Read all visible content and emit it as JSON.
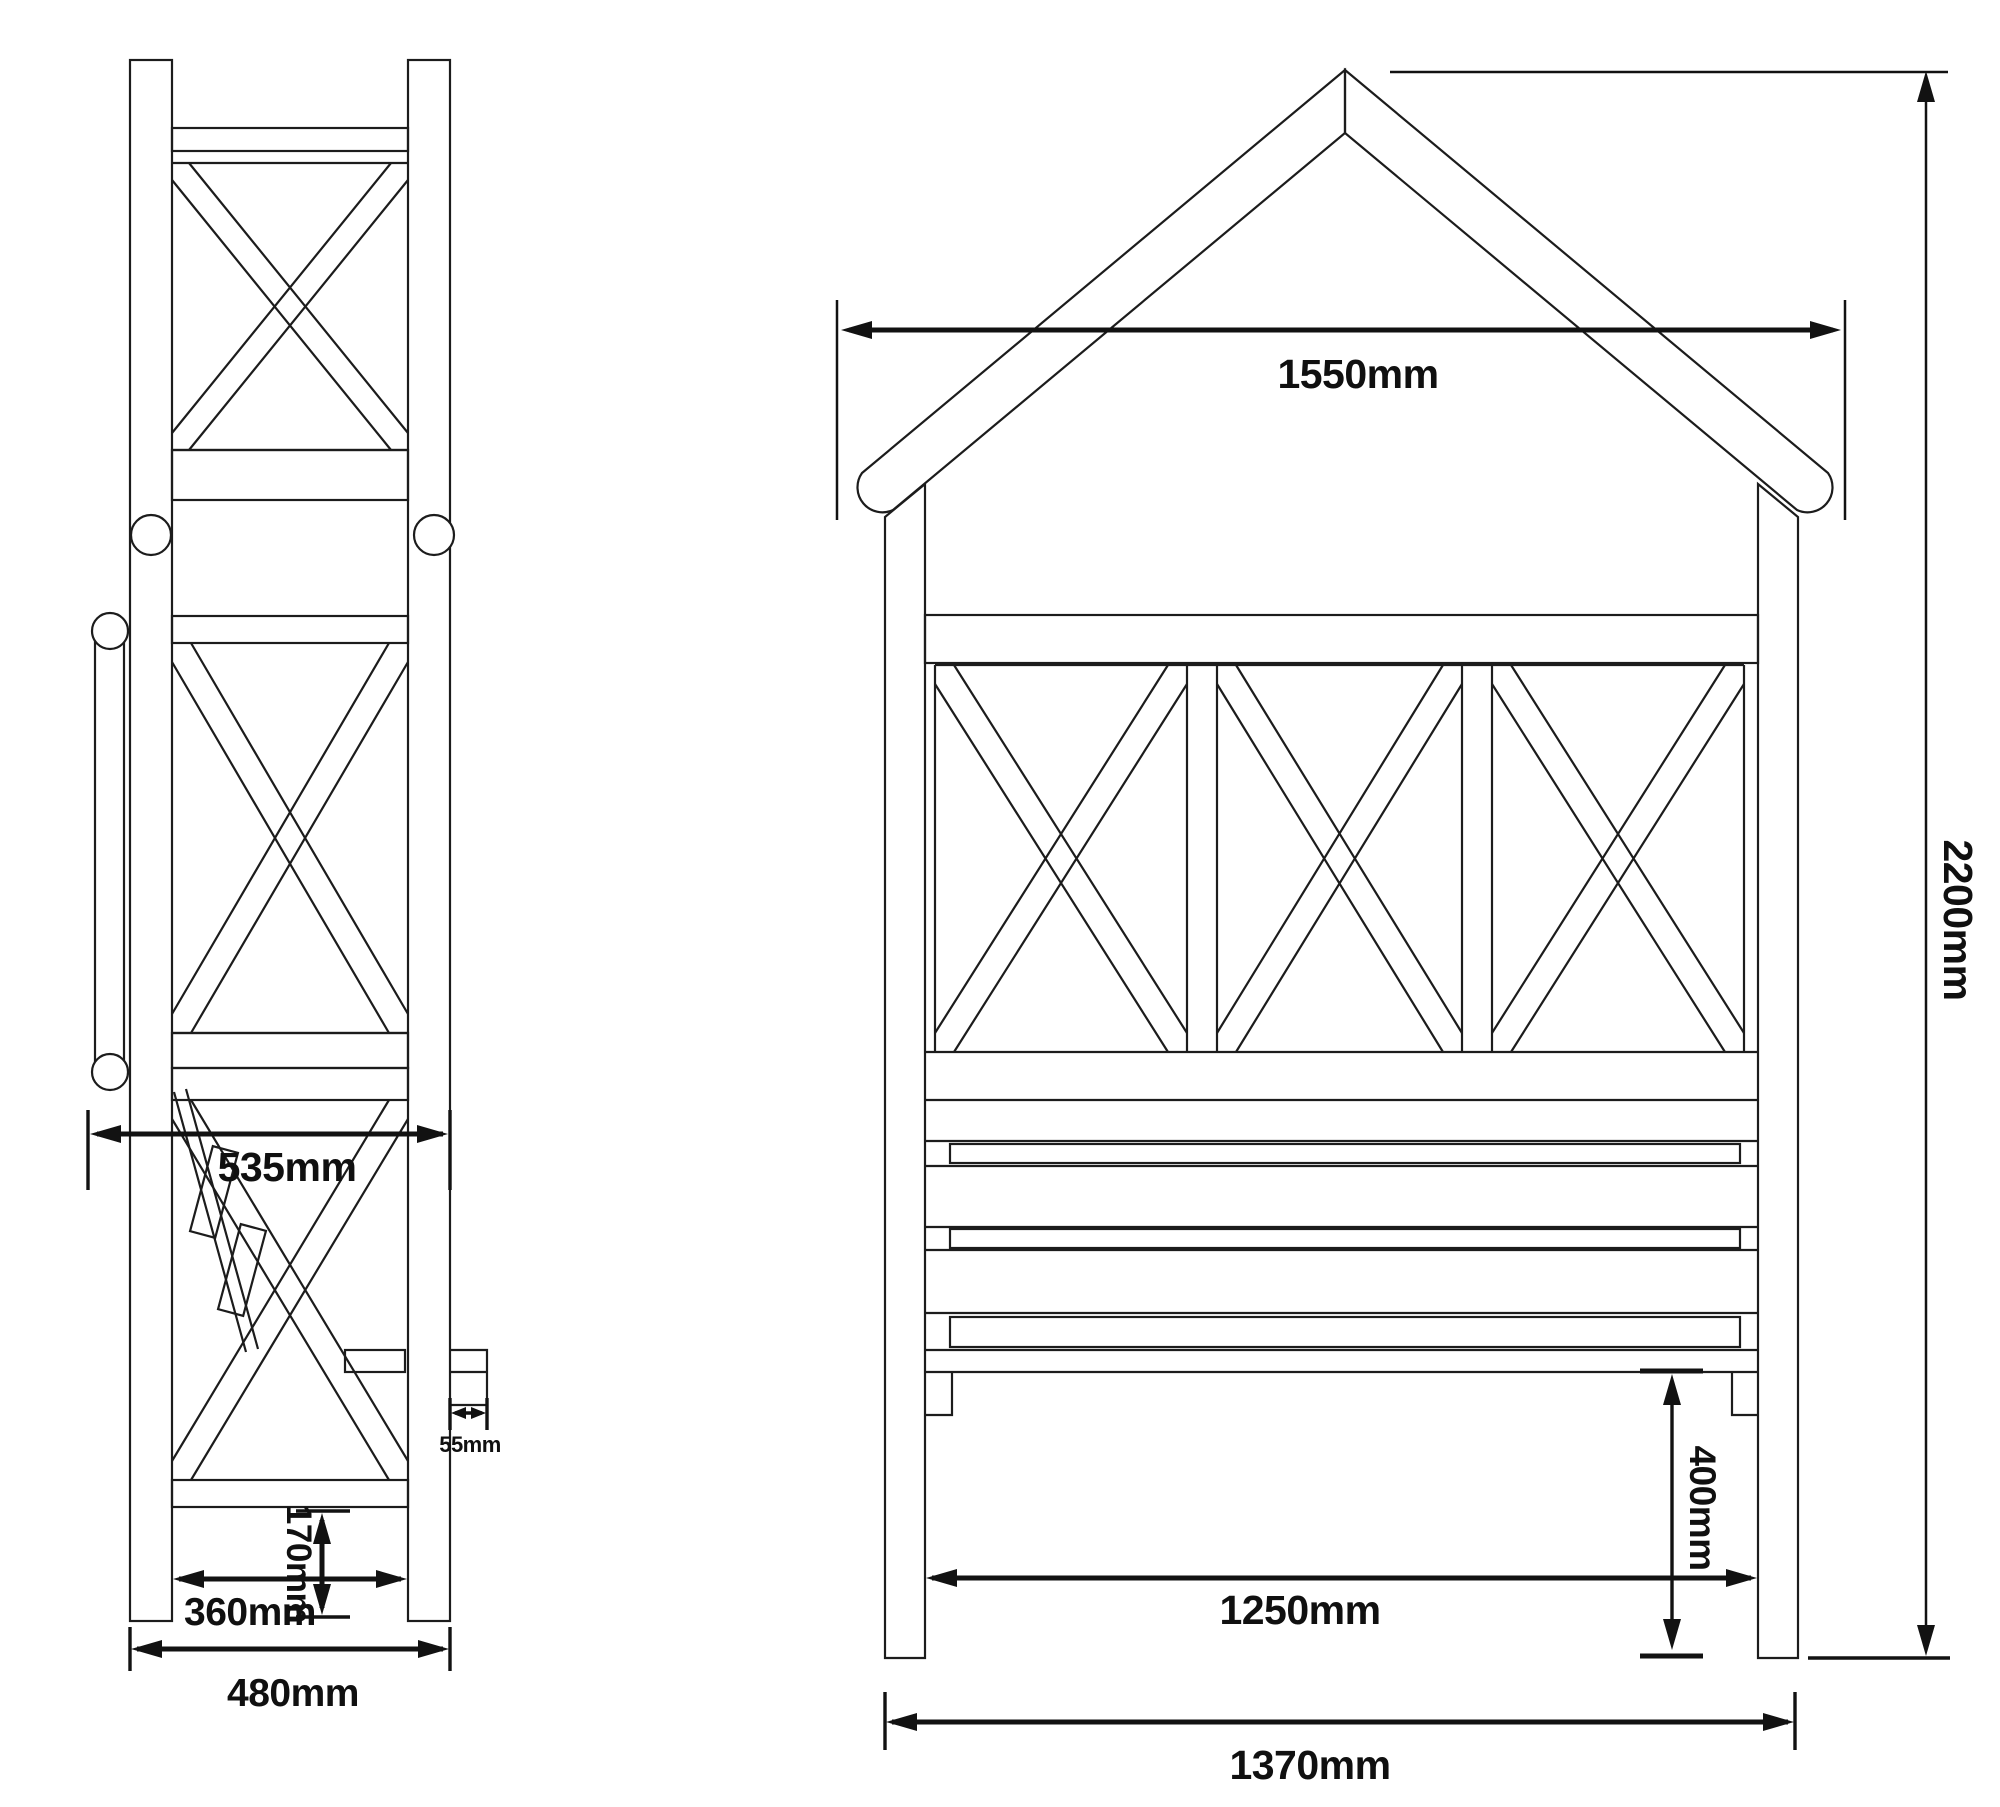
{
  "side_view": {
    "depth_label": "535mm",
    "tab_label": "55mm",
    "clearance_label": "170mm",
    "inner_width_label": "360mm",
    "outer_width_label": "480mm"
  },
  "front_view": {
    "roof_width_label": "1550mm",
    "height_label": "2200mm",
    "seat_height_label": "400mm",
    "inner_width_label": "1250mm",
    "outer_width_label": "1370mm"
  }
}
